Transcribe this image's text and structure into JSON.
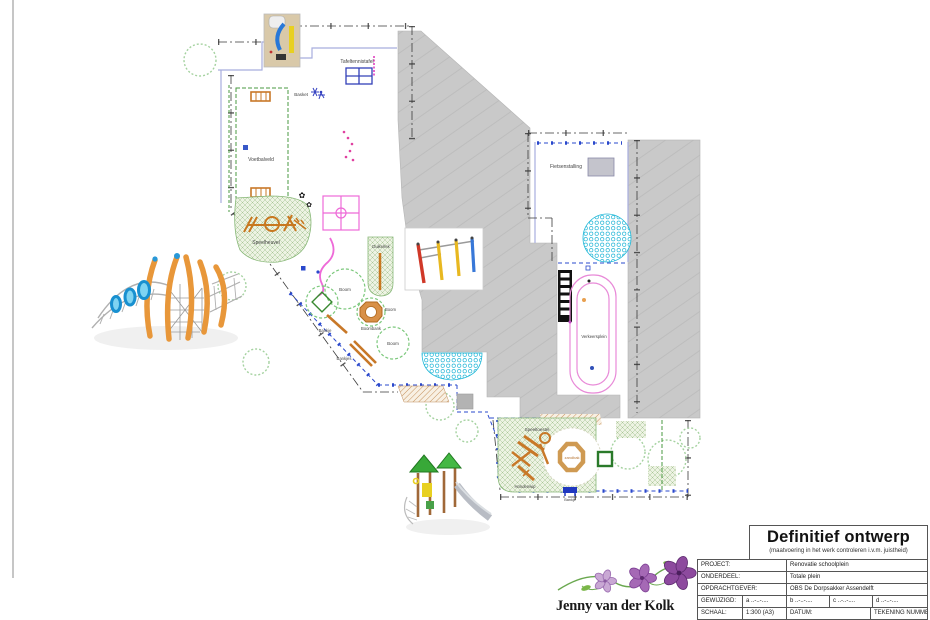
{
  "title_block": {
    "title": "Definitief ontwerp",
    "subtitle": "(maatvoering in het werk controleren i.v.m. juistheid)",
    "project_label": "PROJECT:",
    "project_value": "Renovatie schoolplein",
    "onderdeel_label": "ONDERDEEL:",
    "onderdeel_value": "Totale plein",
    "opdrachtgever_label": "OPDRACHTGEVER:",
    "opdrachtgever_value": "OBS De Dorpsakker Assendelft",
    "gewijzigd_label": "GEWIJZIGD:",
    "gewijzigd_a": "a ..-..-....",
    "gewijzigd_b": "b ..-..-....",
    "gewijzigd_c": "c ..-..-....",
    "gewijzigd_d": "d ..-..-....",
    "schaal_label": "SCHAAL:",
    "schaal_value": "1:300 (A3)",
    "datum_label": "DATUM:",
    "tekening_label": "TEKENING NUMMER:"
  },
  "logo": {
    "name": "Jenny van der Kolk"
  },
  "plan_labels": {
    "tafeltennistafel": "Tafeltennistafel",
    "basket": "Basket",
    "voetbalveld": "Voetbalveld",
    "speelheuvel": "Speelheuvel",
    "duikelrek": "Duikelrek",
    "boom_a": "Boom",
    "boom_b": "Boom",
    "boom_c": "Boom",
    "boombank": "Boombank",
    "bankje": "Bankje",
    "bankjes": "Bankjes",
    "fietsenstalling": "Fietsenstalling",
    "verkeersplein": "Verkeersplein",
    "speeltoestel": "Speeltoestel",
    "zandbak": "zandbak",
    "hondenwip": "Hondenwip",
    "bankje_2": "Bankje"
  },
  "colors": {
    "building_gray": "#c9c9c9",
    "accent_green": "#7cc87c",
    "accent_blue": "#2a48cc",
    "accent_magenta": "#ee6ad8",
    "accent_orange": "#c87828",
    "accent_cyan": "#28b8d8",
    "flower_dark": "#8d4a9e",
    "flower_mid": "#a569b5",
    "flower_light": "#c9a8d4"
  }
}
